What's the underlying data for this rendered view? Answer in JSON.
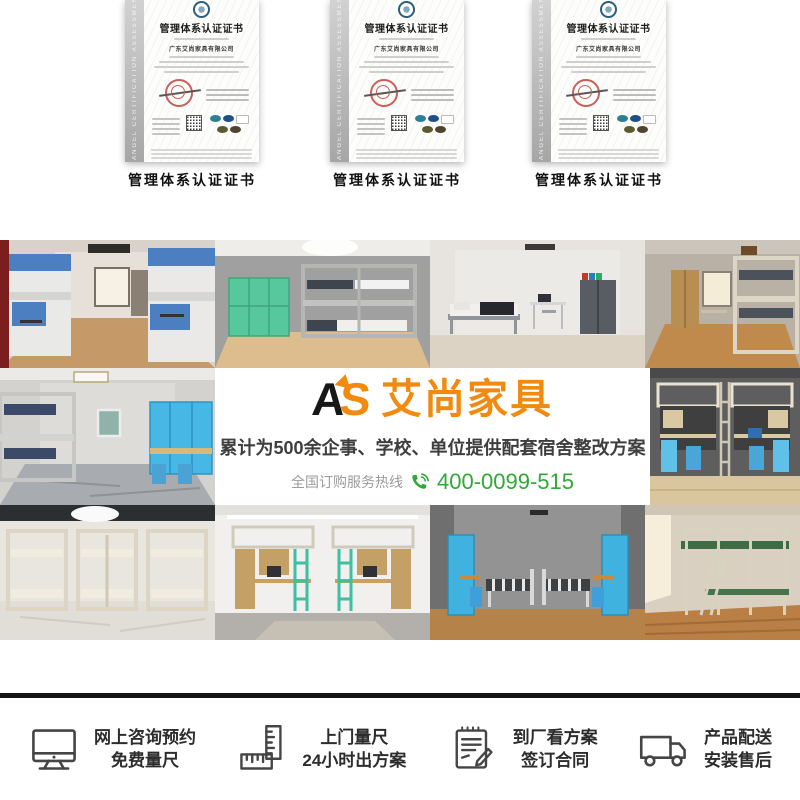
{
  "certificates": {
    "ribbon_text": "ANGEL CERTIFICATION ASSESSMENT SERVICES",
    "title": "管理体系认证证书",
    "company": "广东艾尚家具有限公司",
    "caption": "管理体系认证证书"
  },
  "banner": {
    "logo_monogram_a": "A",
    "logo_monogram_s": "S",
    "logo_name": "艾尚家具",
    "headline": "累计为500余企事、学校、单位提供配套宿舍整改方案",
    "hotline_label": "全国订购服务热线",
    "hotline_number": "400-0099-515",
    "accent_orange": "#f18a0f",
    "accent_green": "#2faa35"
  },
  "gallery": {
    "photos": [
      {
        "alt": "蓝色双层床带书桌宿舍"
      },
      {
        "alt": "绿色储物柜与灰色双层床宿舍"
      },
      {
        "alt": "单人床书桌铁皮柜房间"
      },
      {
        "alt": "木质家具学生宿舍"
      },
      {
        "alt": "灰色宿舍蓝色储物柜组合"
      },
      {
        "alt": "深色背景上床下桌蓝色组合"
      },
      {
        "alt": "米色三组双层床宿舍"
      },
      {
        "alt": "上床下桌带衣柜绿梯宿舍"
      },
      {
        "alt": "蓝色衣柜单人铁床宿舍"
      },
      {
        "alt": "绿色台面钢木公寓床"
      }
    ]
  },
  "services": {
    "items": [
      {
        "icon": "monitor-icon",
        "line1": "网上咨询预约",
        "line2": "免费量尺"
      },
      {
        "icon": "ruler-icon",
        "line1": "上门量尺",
        "line2": "24小时出方案"
      },
      {
        "icon": "contract-icon",
        "line1": "到厂看方案",
        "line2": "签订合同"
      },
      {
        "icon": "truck-icon",
        "line1": "产品配送",
        "line2": "安装售后"
      }
    ]
  }
}
